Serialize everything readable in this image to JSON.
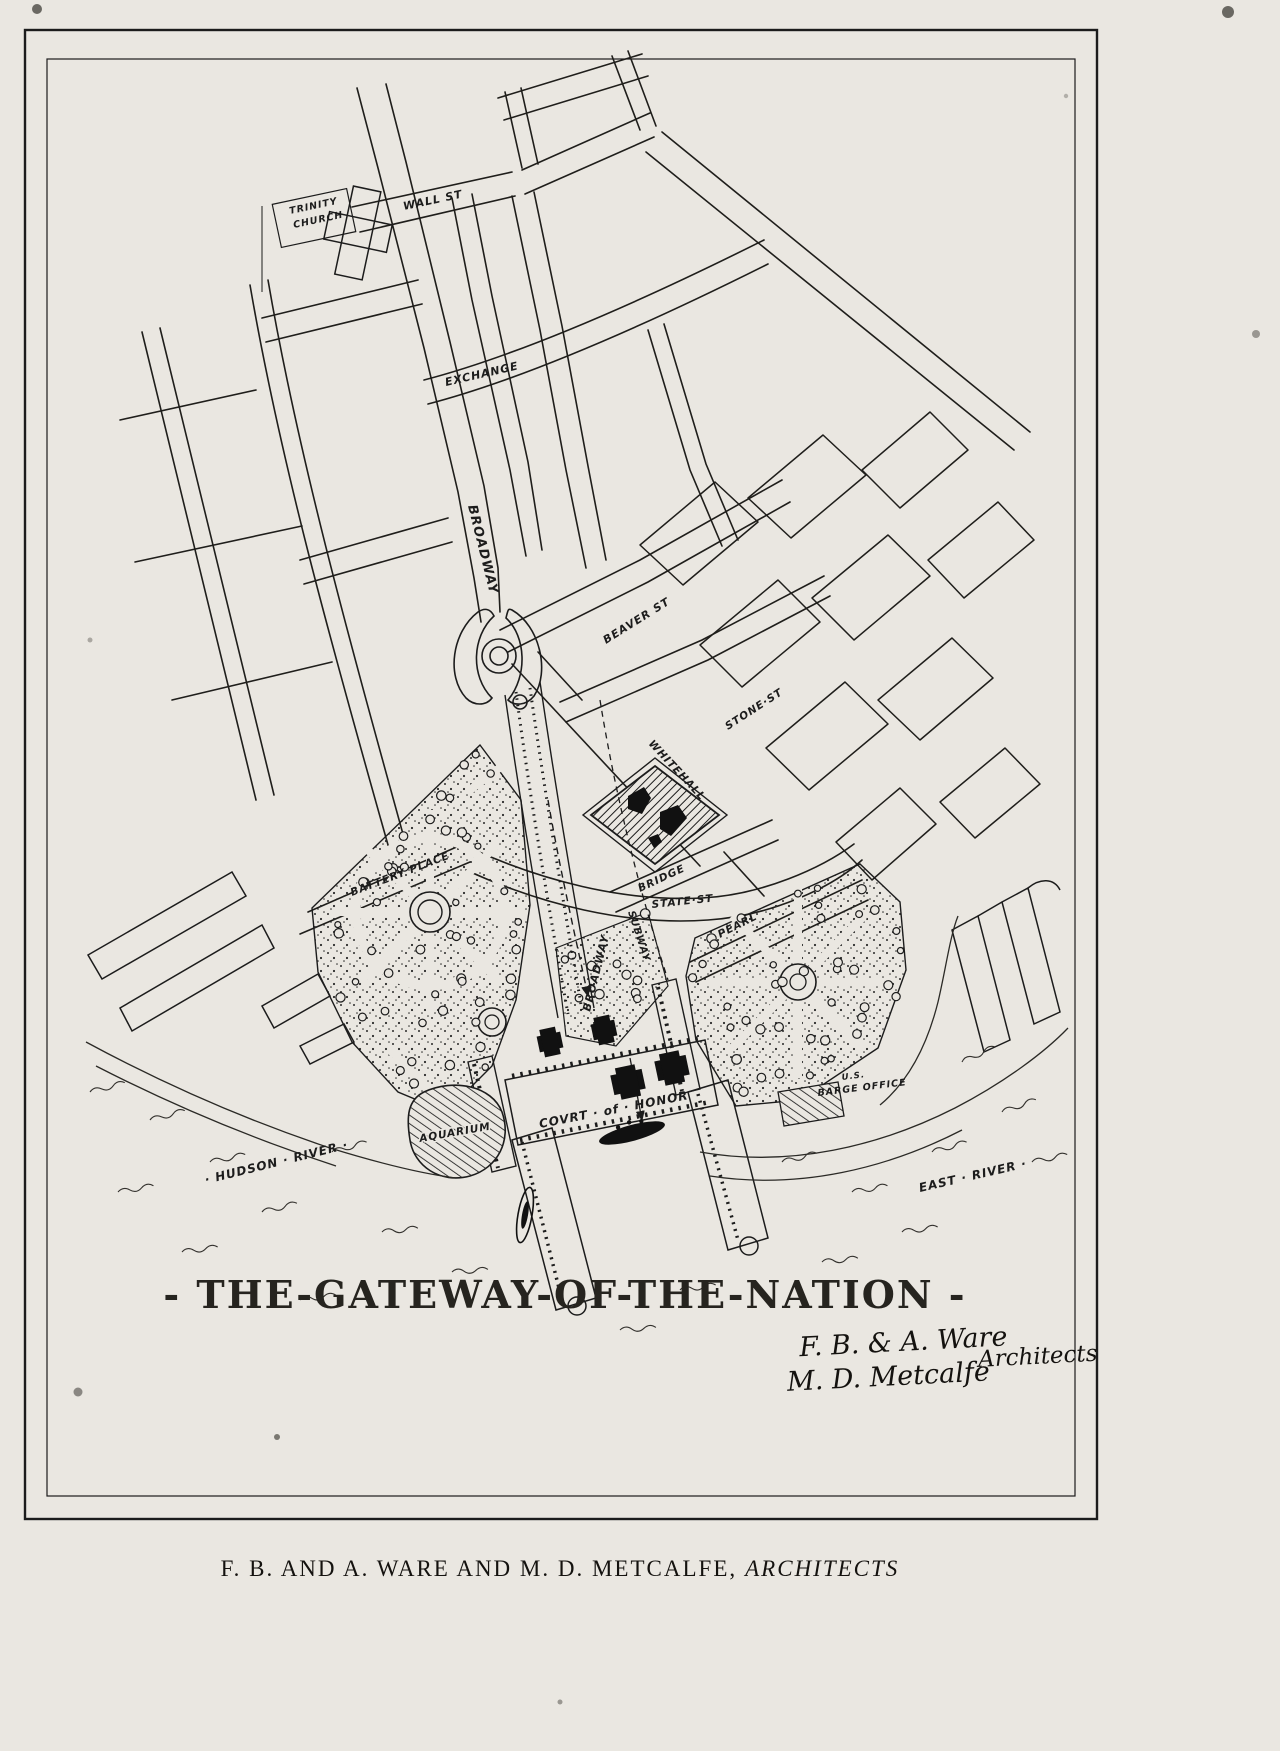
{
  "title": "- THE-GATEWAY-OF-THE-NATION -",
  "page_caption": {
    "names": "F. B. AND A. WARE AND M. D. METCALFE,",
    "role": "ARCHITECTS"
  },
  "signature": {
    "line1": "F. B. & A. Ware",
    "line2": "M. D. Metcalfe",
    "role": "Architects"
  },
  "labels": {
    "trinity1": "TRINITY",
    "trinity2": "CHURCH",
    "wall": "WALL ST",
    "exchange": "EXCHANGE",
    "broadway": "BROADWAY",
    "beaver": "BEAVER ST",
    "stone": "STONE·ST",
    "whitehall": "WHITEHALL",
    "battery_place": "BATTERY  PLACE",
    "bridge": "BRIDGE",
    "pearl": "PEARL",
    "state": "STATE·ST",
    "broadway_axis": "BROADWAY",
    "subway": "SUBWAY",
    "aquarium": "AQUARIUM",
    "court": "COVRT · of · HONOR",
    "barge1": "U.S.",
    "barge2": "BARGE OFFICE",
    "hudson": "· HUDSON · RIVER ·",
    "east_river": "EAST · RIVER ·"
  },
  "colors": {
    "paper": "#eae7e1",
    "ink": "#1c1c1c"
  }
}
